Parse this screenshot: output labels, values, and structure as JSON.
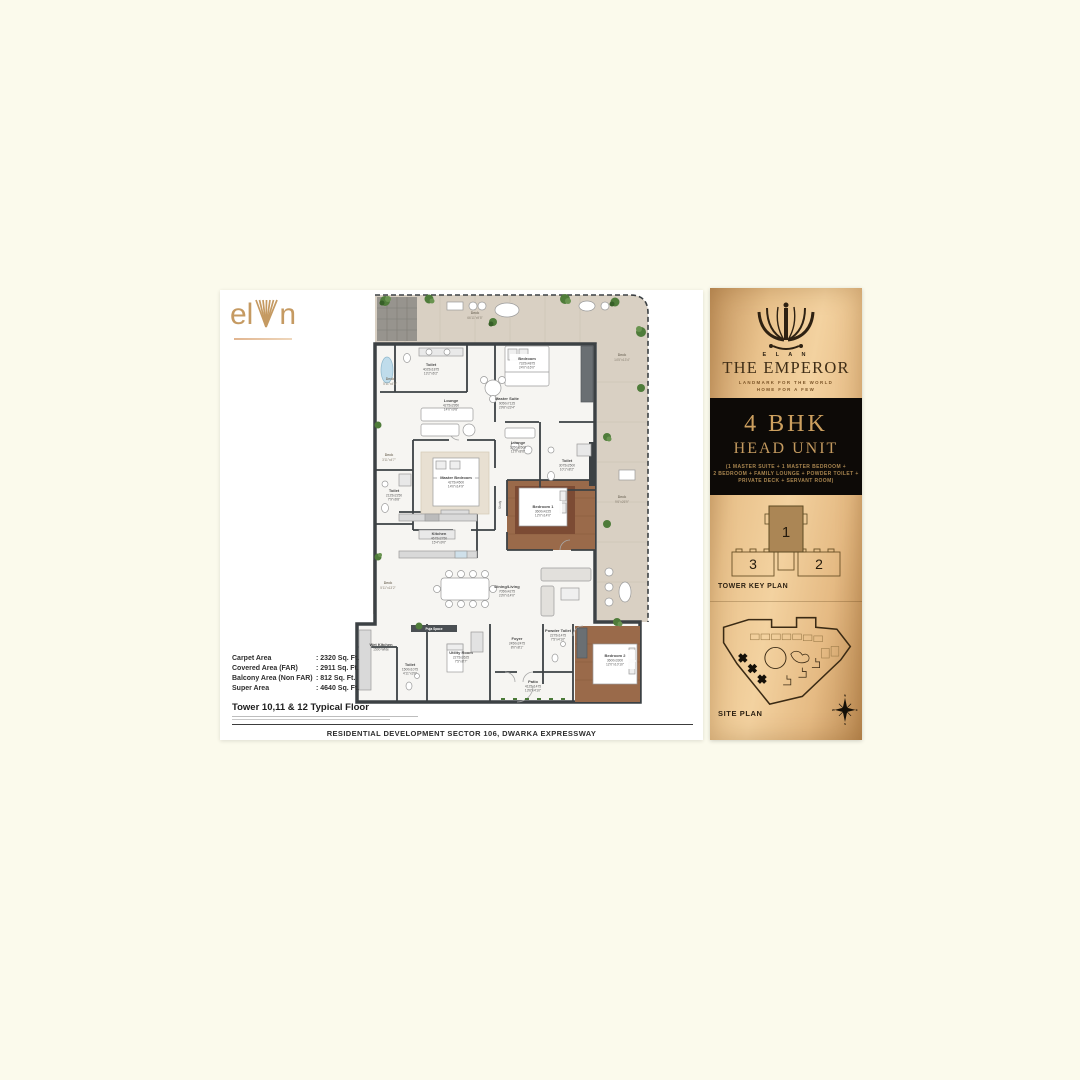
{
  "area_table": {
    "rows": [
      {
        "label": "Carpet Area",
        "value": ": 2320 Sq. Ft."
      },
      {
        "label": "Covered Area (FAR)",
        "value": ": 2911 Sq. Ft."
      },
      {
        "label": "Balcony Area (Non FAR)",
        "value": ": 812 Sq. Ft."
      },
      {
        "label": "Super Area",
        "value": ": 4640 Sq. Ft."
      }
    ],
    "floor_title": "Tower 10,11 & 12 Typical Floor",
    "footer": "RESIDENTIAL DEVELOPMENT SECTOR 106, DWARKA EXPRESSWAY"
  },
  "logo": {
    "el": "el",
    "n": "n"
  },
  "sidebar": {
    "brand_small": "E L A N",
    "title": "THE EMPEROR",
    "tagline_line1": "LANDMARK FOR THE WORLD",
    "tagline_line2": "HOME FOR A FEW",
    "unit": {
      "type": "4 BHK",
      "subtitle": "HEAD UNIT",
      "desc_line1": "(1 MASTER SUITE + 1 MASTER BEDROOM +",
      "desc_line2": "2 BEDROOM + FAMILY LOUNGE + POWDER TOILET +",
      "desc_line3": "PRIVATE DECK + SERVANT ROOM)"
    },
    "key_plan": {
      "label": "TOWER KEY PLAN",
      "unit1": "1",
      "unit2": "2",
      "unit3": "3"
    },
    "site_plan": {
      "label": "SITE PLAN"
    },
    "compass": {
      "n": "N",
      "s": "S",
      "e": "E",
      "w": "W"
    },
    "colors": {
      "gold_bg": "#e9c28c",
      "black_box": "#0d0a07",
      "gold_text": "#c49a5f"
    }
  },
  "plan": {
    "rooms": {
      "deck_top": {
        "name": "Deck",
        "size": "66'11\"x9'5\""
      },
      "deck_right_top": {
        "name": "Deck",
        "size": "14'5\"x13'4\""
      },
      "deck_right_mid": {
        "name": "Deck",
        "size": "9'6\"x26'9\""
      },
      "deck_left_1": {
        "name": "Deck",
        "size": "5'11\"x4'8\""
      },
      "deck_left_2": {
        "name": "Deck",
        "size": "3'11\"x4'7\""
      },
      "deck_bottom_left": {
        "name": "Deck",
        "size": "5'11\"x13'2\""
      },
      "toilet_master": {
        "name": "Toilet",
        "metric": "4025x1875",
        "imperial": "13'2\"x6'2\""
      },
      "bedroom_top": {
        "name": "Bedroom",
        "metric": "7325x4875",
        "imperial": "24'0\"x16'0\""
      },
      "master_suite": {
        "name": "Master Suite",
        "metric": "9050x7125",
        "imperial": "29'8\"x23'4\""
      },
      "lounge_family": {
        "name": "Lounge",
        "metric": "4275x2950",
        "imperial": "14'0\"x9'8\""
      },
      "master_bedroom": {
        "name": "Master Bedroom",
        "metric": "4275x4500",
        "imperial": "14'0\"x14'9\""
      },
      "lounge_small": {
        "name": "Lounge",
        "metric": "3350x2600",
        "imperial": "11'0\"x8'6\""
      },
      "toilet_left": {
        "name": "Toilet",
        "metric": "2125x2250",
        "imperial": "7'9\"x6'8\""
      },
      "toilet_mid": {
        "name": "Toilet",
        "metric": "3075x2500",
        "imperial": "10'1\"x8'2\""
      },
      "bedroom_1": {
        "name": "Bedroom 1",
        "metric": "3600x4225",
        "imperial": "12'0\"x14'0\""
      },
      "kitchen": {
        "name": "Kitchen",
        "metric": "4675x2750",
        "imperial": "15'4\"x9'0\""
      },
      "dining_living": {
        "name": "Dining/Living",
        "metric": "7050x4275",
        "imperial": "23'0\"x14'0\""
      },
      "wet_kitchen": {
        "name": "Wet Kitchen",
        "metric": "1500 Wide"
      },
      "toilet_small": {
        "name": "Toilet",
        "metric": "1500x1075",
        "imperial": "4'11\"x3'6\""
      },
      "utility": {
        "name": "Utility Room",
        "metric": "2275x2625",
        "imperial": "7'5\"x8'7\""
      },
      "foyer": {
        "name": "Foyer",
        "metric": "2450x2475",
        "imperial": "8'0\"x8'1\""
      },
      "powder": {
        "name": "Powder Toilet",
        "metric": "2275x1475",
        "imperial": "7'5\"x4'10\""
      },
      "patio": {
        "name": "Patio",
        "metric": "4125x1475",
        "imperial": "13'6\"x4'10\""
      },
      "bedroom_2": {
        "name": "Bedroom 2",
        "metric": "3600x3300",
        "imperial": "12'0\"x10'10\""
      },
      "puja": {
        "name": "Puja Space"
      },
      "study": {
        "name": "Study"
      }
    }
  }
}
